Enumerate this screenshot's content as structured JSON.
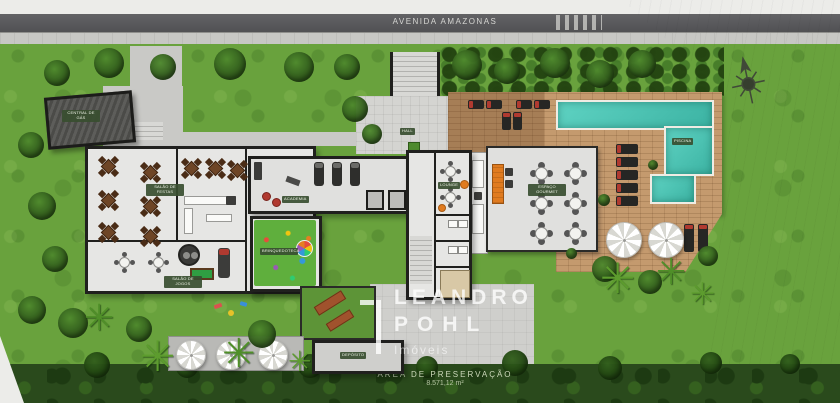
{
  "scene": {
    "street_label": "AVENIDA AMAZONAS",
    "preservation_label": "ÁREA DE PRESERVAÇÃO",
    "preservation_area": "8.571,12 m²"
  },
  "logo": {
    "line1": "LEANDRO",
    "line2": "POHL",
    "line3": "Imóveis"
  },
  "rooms": {
    "service": "CENTRAL DE GÁS",
    "party_hall": "SALÃO DE FESTAS",
    "games": "SALÃO DE JOGOS",
    "gym": "ACADEMIA",
    "playroom": "BRINQUEDOTECA",
    "hall": "HALL",
    "lounge": "LOUNGE",
    "gourmet": "ESPAÇO GOURMET",
    "pool": "PISCINA",
    "storage": "DEPÓSITO"
  },
  "colors": {
    "road": "#57575a",
    "sidewalk": "#c6c6c3",
    "grass": "#69a23d",
    "preservation_band": "#2a4a1c",
    "pool_water": "#49c2b2",
    "wood_deck": "#c49a6e",
    "accent_red": "#b03a30",
    "accent_orange": "#e07b1f",
    "logo_text": "#ffffff"
  }
}
